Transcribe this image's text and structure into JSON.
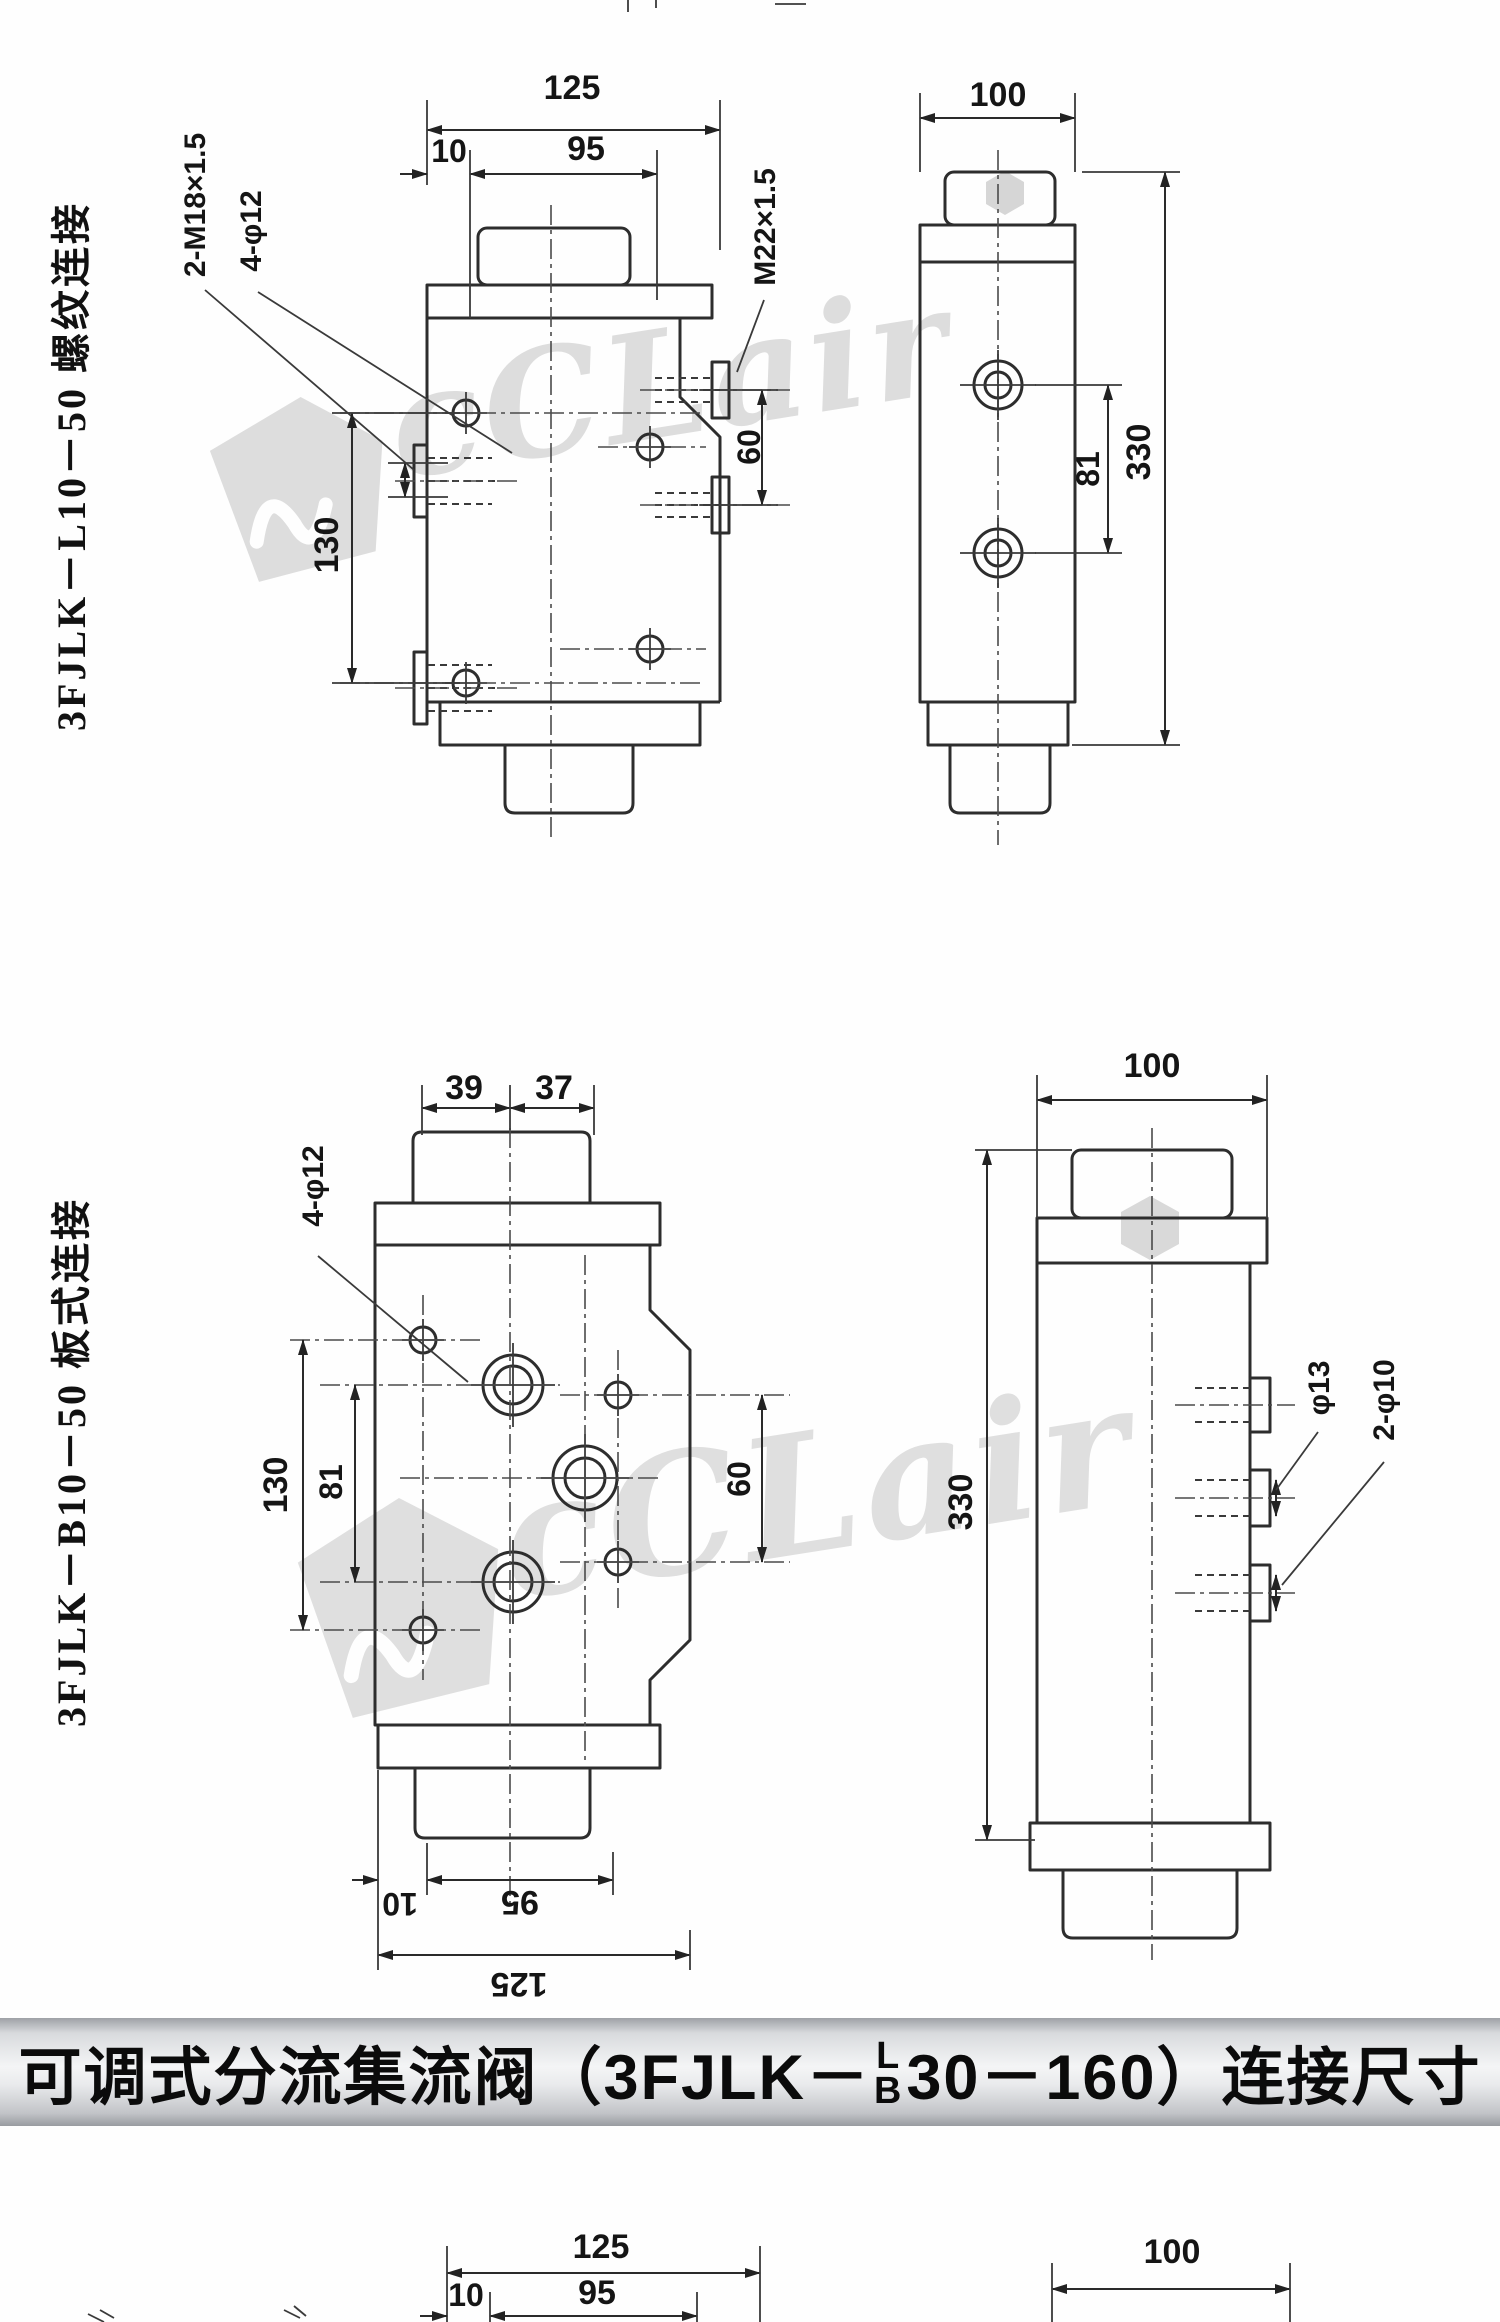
{
  "watermark": {
    "logo_text": "cCLair"
  },
  "drawing1": {
    "side_label": "3FJLK－L10－50 螺纹连接",
    "front": {
      "dim_overall_width": "125",
      "dim_port_offset": "10",
      "dim_span": "95",
      "callout_side_ports": "2-M18×1.5",
      "callout_mount_holes": "4-φ12",
      "dim_hole_spacing": "130",
      "dim_outlet_spacing": "60",
      "callout_outlet_port": "M22×1.5"
    },
    "side": {
      "dim_width": "100",
      "dim_port_spacing": "81",
      "dim_height": "330"
    }
  },
  "drawing2": {
    "side_label": "3FJLK－B10－50 板式连接",
    "front": {
      "dim_boss_left": "39",
      "dim_boss_right": "37",
      "callout_mount_holes": "4-φ12",
      "dim_hole_spacing": "130",
      "dim_port_spacing": "81",
      "dim_right_spacing": "60",
      "dim_bottom_offset": "10",
      "dim_bottom_span": "95",
      "dim_bottom_overall": "125"
    },
    "side": {
      "dim_width": "100",
      "dim_height": "330",
      "callout_gauge_port": "φ13",
      "callout_small_ports": "2-φ10"
    }
  },
  "title_bar": {
    "prefix": "可调式分流集流阀（3FJLK－",
    "frac_top": "L",
    "frac_bottom": "B",
    "suffix": "30－160）连接尺寸"
  },
  "drawing3": {
    "dim_overall_width": "125",
    "dim_offset": "10",
    "dim_span": "95",
    "dim_side_width": "100"
  }
}
